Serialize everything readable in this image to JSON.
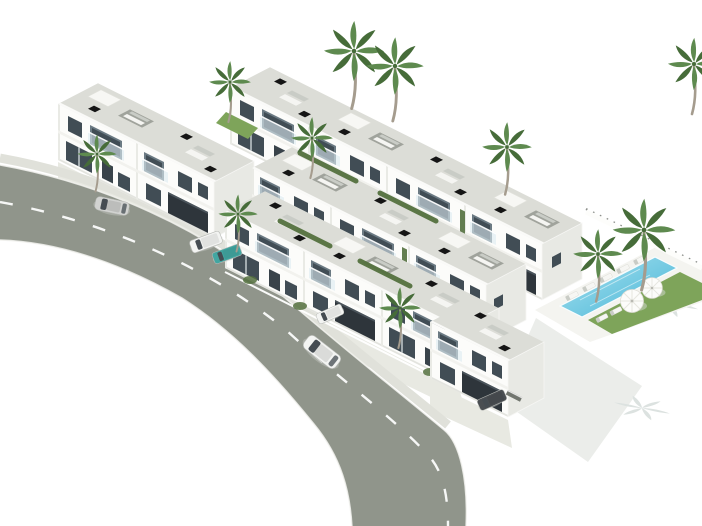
{
  "scene": {
    "type": "3d-architectural-render",
    "description": "Aerial isometric rendering of a white modern residential development: rows of two-storey townhouses with rooftop terraces and chimneys, palm trees, a communal swimming pool with lawn and parasols on the right, and a curved asphalt street with cars along the lower left.",
    "background_color": "#ffffff"
  },
  "palette": {
    "background": "#ffffff",
    "road_asphalt": "#90958b",
    "road_marking": "#ffffff",
    "sidewalk": "#e0e1da",
    "apron": "#e8e9e2",
    "building_wall": "#fcfcfa",
    "building_wall_shade": "#e8e9e4",
    "roof": "#dcddd7",
    "roof_parapet": "#fafaf8",
    "window_glass": "#414d55",
    "window_recess": "#6b7a83",
    "slab": "#f2f2ee",
    "balustrade": "#dcebf1",
    "chimney": "#151515",
    "garage_door": "#2e353b",
    "pool_water_light": "#aae2f0",
    "pool_water": "#45b5d6",
    "pool_deck": "#f4f4f0",
    "grass": "#7ea45a",
    "hedge": "#53703e",
    "palm_frond": "#5e8a4f",
    "palm_frond_dark": "#466c39",
    "palm_trunk": "#a59c8e",
    "shadow_soft": "#ebedea",
    "shadow_palm": "#dce2e0",
    "furniture_white": "#f5f5f2",
    "furniture_gray": "#c9ccc6",
    "pergola_gray": "#999c96",
    "car_silver": "#d2d3d1",
    "car_white": "#f3f4f2",
    "car_teal": "#42a6a1",
    "car_dark": "#4a4e52"
  },
  "objects": {
    "road": {
      "kind": "curved asphalt street",
      "marking": "dashed white center line",
      "cars_on_road": 2
    },
    "cars": [
      {
        "id": "sedan-on-road",
        "color_key": "car_silver"
      },
      {
        "id": "suv-on-road",
        "color_key": "car_white"
      },
      {
        "id": "van-parked-left-driveway",
        "color_key": "car_white"
      },
      {
        "id": "hatchback-parked-left-driveway",
        "color_key": "car_teal"
      },
      {
        "id": "van-parked-front-driveway",
        "color_key": "car_white"
      },
      {
        "id": "car-parked-carport",
        "color_key": "car_dark"
      }
    ],
    "buildings": {
      "rows": [
        {
          "id": "back-row",
          "units": 4
        },
        {
          "id": "left-block",
          "units": 2
        },
        {
          "id": "middle-row",
          "units": 3
        },
        {
          "id": "front-row",
          "units": 3
        },
        {
          "id": "corner-house",
          "units": 1
        }
      ],
      "features": [
        "rooftop terraces",
        "glass balustrades",
        "black chimneys",
        "garages",
        "roof furniture"
      ]
    },
    "pool_area": {
      "pool": "communal swimming pool",
      "loungers": 7,
      "umbrellas": 2,
      "lawn": true,
      "perimeter_wall": true
    },
    "vegetation": {
      "palm_trees": 11,
      "hedges": true,
      "grass_patches": true
    }
  }
}
